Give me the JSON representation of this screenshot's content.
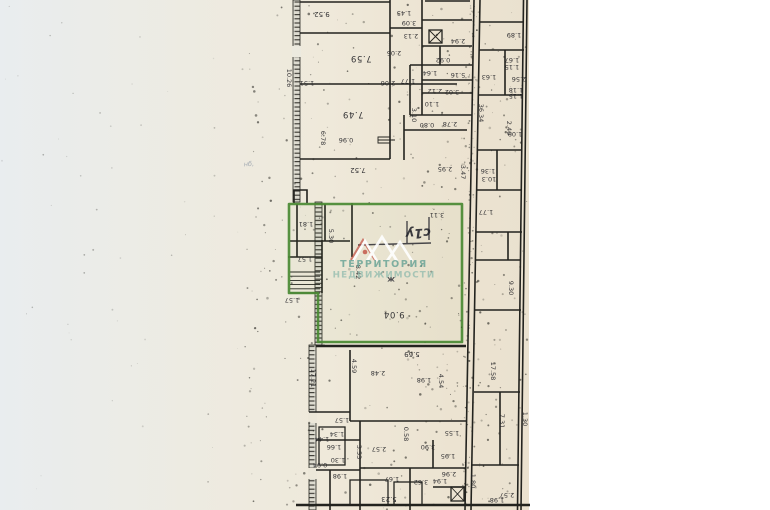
{
  "scan": {
    "paper_tint_left": "#e9edef",
    "paper_tint_mid": "#efe9da",
    "paper_tint_right": "#eae1cf",
    "ink_color": "#26262a",
    "note": "scanned BTI floor plan, rotated 180deg (dimension labels upside down)"
  },
  "highlight": {
    "color": "#4a8a33"
  },
  "watermark": {
    "line1": "ТЕРРИТОРИЯ",
    "line2": "НЕДВИЖИМОСТИ",
    "color_line1": "#5f9e91",
    "color_line2": "#83b4a8",
    "roof_color": "#ffffff",
    "roof_accent": "#c0493d"
  },
  "plan": {
    "texts": [
      {
        "t": "9.52",
        "x": 322,
        "y": 12,
        "r": 180,
        "c": "dim med"
      },
      {
        "t": "1.45",
        "x": 404,
        "y": 11,
        "r": 180,
        "c": "dim"
      },
      {
        "t": "3.09",
        "x": 409,
        "y": 21,
        "r": 180,
        "c": "dim"
      },
      {
        "t": "2.13",
        "x": 411,
        "y": 34,
        "r": 180,
        "c": "dim"
      },
      {
        "t": "2.94",
        "x": 458,
        "y": 39,
        "r": 180,
        "c": "dim"
      },
      {
        "t": "7.59",
        "x": 361,
        "y": 56,
        "r": 180,
        "c": "dim big"
      },
      {
        "t": "2.05",
        "x": 394,
        "y": 51,
        "r": 180,
        "c": "dim"
      },
      {
        "t": "0.92",
        "x": 443,
        "y": 58,
        "r": 180,
        "c": "dim"
      },
      {
        "t": "1.64",
        "x": 430,
        "y": 71,
        "r": 180,
        "c": "dim"
      },
      {
        "t": "5.16",
        "x": 458,
        "y": 73,
        "r": 180,
        "c": "dim"
      },
      {
        "t": "1.77",
        "x": 408,
        "y": 79,
        "r": 180,
        "c": "dim"
      },
      {
        "t": "2.12",
        "x": 435,
        "y": 89,
        "r": 180,
        "c": "dim"
      },
      {
        "t": "3.02",
        "x": 452,
        "y": 90,
        "r": 180,
        "c": "dim"
      },
      {
        "t": "1.10",
        "x": 432,
        "y": 102,
        "r": 180,
        "c": "dim"
      },
      {
        "t": "3.10",
        "x": 412,
        "y": 115,
        "r": 90,
        "c": "dim"
      },
      {
        "t": "0.80",
        "x": 427,
        "y": 123,
        "r": 180,
        "c": "dim"
      },
      {
        "t": "2.78",
        "x": 450,
        "y": 122,
        "r": 180,
        "c": "dim"
      },
      {
        "t": "10.26",
        "x": 287,
        "y": 78,
        "r": 90,
        "c": "dim"
      },
      {
        "t": "1.51",
        "x": 307,
        "y": 81,
        "r": 180,
        "c": "dim"
      },
      {
        "t": "2.06",
        "x": 388,
        "y": 81,
        "r": 180,
        "c": "dim"
      },
      {
        "t": "7.49",
        "x": 353,
        "y": 112,
        "r": 180,
        "c": "dim big"
      },
      {
        "t": "6.78",
        "x": 321,
        "y": 138,
        "r": 90,
        "c": "dim"
      },
      {
        "t": "0.96",
        "x": 346,
        "y": 138,
        "r": 180,
        "c": "dim"
      },
      {
        "t": "7.52",
        "x": 358,
        "y": 168,
        "r": 180,
        "c": "dim med"
      },
      {
        "t": "2.95",
        "x": 445,
        "y": 167,
        "r": 180,
        "c": "dim"
      },
      {
        "t": "3.47",
        "x": 461,
        "y": 172,
        "r": 90,
        "c": "dim"
      },
      {
        "t": "3.11",
        "x": 437,
        "y": 213,
        "r": 180,
        "c": "dim"
      },
      {
        "t": "1.81",
        "x": 306,
        "y": 222,
        "r": 180,
        "c": "dim"
      },
      {
        "t": "5.30",
        "x": 329,
        "y": 236,
        "r": 90,
        "c": "dim"
      },
      {
        "t": "1.57",
        "x": 305,
        "y": 257,
        "r": 180,
        "c": "dim"
      },
      {
        "t": "8.42",
        "x": 356,
        "y": 272,
        "r": 90,
        "c": "dim"
      },
      {
        "t": "1.57",
        "x": 292,
        "y": 298,
        "r": 180,
        "c": "dim"
      },
      {
        "t": "9.04",
        "x": 394,
        "y": 312,
        "r": 180,
        "c": "dim big"
      },
      {
        "t": "17.21",
        "x": 311,
        "y": 378,
        "r": 90,
        "c": "dim"
      },
      {
        "t": "4.59",
        "x": 352,
        "y": 366,
        "r": 90,
        "c": "dim"
      },
      {
        "t": "2.48",
        "x": 378,
        "y": 371,
        "r": 180,
        "c": "dim"
      },
      {
        "t": "5.69",
        "x": 412,
        "y": 352,
        "r": 180,
        "c": "dim med"
      },
      {
        "t": "1.98",
        "x": 424,
        "y": 378,
        "r": 180,
        "c": "dim"
      },
      {
        "t": "4.54",
        "x": 439,
        "y": 381,
        "r": 90,
        "c": "dim"
      },
      {
        "t": "1.57",
        "x": 342,
        "y": 418,
        "r": 180,
        "c": "dim"
      },
      {
        "t": "1.34",
        "x": 337,
        "y": 432,
        "r": 180,
        "c": "dim"
      },
      {
        "t": "1.44",
        "x": 322,
        "y": 437,
        "r": 180,
        "c": "dim"
      },
      {
        "t": "1.66",
        "x": 334,
        "y": 445,
        "r": 180,
        "c": "dim"
      },
      {
        "t": "3.53",
        "x": 357,
        "y": 452,
        "r": 90,
        "c": "dim"
      },
      {
        "t": "2.57",
        "x": 379,
        "y": 447,
        "r": 180,
        "c": "dim"
      },
      {
        "t": "0.58",
        "x": 404,
        "y": 434,
        "r": 90,
        "c": "dim"
      },
      {
        "t": "3.90",
        "x": 428,
        "y": 445,
        "r": 180,
        "c": "dim"
      },
      {
        "t": "1.95",
        "x": 448,
        "y": 454,
        "r": 180,
        "c": "dim"
      },
      {
        "t": "1.30",
        "x": 338,
        "y": 458,
        "r": 180,
        "c": "dim"
      },
      {
        "t": "0.94",
        "x": 320,
        "y": 463,
        "r": 180,
        "c": "dim"
      },
      {
        "t": "1.98",
        "x": 340,
        "y": 474,
        "r": 180,
        "c": "dim"
      },
      {
        "t": "1.67",
        "x": 392,
        "y": 477,
        "r": 180,
        "c": "dim"
      },
      {
        "t": "3.62",
        "x": 421,
        "y": 480,
        "r": 180,
        "c": "dim"
      },
      {
        "t": "1.94",
        "x": 440,
        "y": 479,
        "r": 180,
        "c": "dim"
      },
      {
        "t": "2.96",
        "x": 449,
        "y": 472,
        "r": 180,
        "c": "dim"
      },
      {
        "t": "5.23",
        "x": 389,
        "y": 497,
        "r": 180,
        "c": "dim med"
      },
      {
        "t": "1.80",
        "x": 471,
        "y": 481,
        "r": 90,
        "c": "dim"
      },
      {
        "t": "2.57",
        "x": 507,
        "y": 493,
        "r": 180,
        "c": "dim"
      },
      {
        "t": "1.98",
        "x": 497,
        "y": 498,
        "r": 180,
        "c": "dim"
      },
      {
        "t": "1.89",
        "x": 514,
        "y": 33,
        "r": 180,
        "c": "dim"
      },
      {
        "t": "1.67",
        "x": 512,
        "y": 58,
        "r": 180,
        "c": "dim"
      },
      {
        "t": "1.15",
        "x": 512,
        "y": 65,
        "r": 180,
        "c": "dim"
      },
      {
        "t": "2.56",
        "x": 519,
        "y": 77,
        "r": 180,
        "c": "dim"
      },
      {
        "t": "1.18",
        "x": 516,
        "y": 88,
        "r": 180,
        "c": "dim"
      },
      {
        "t": "1.15",
        "x": 516,
        "y": 94,
        "r": 180,
        "c": "dim"
      },
      {
        "t": "1.63",
        "x": 489,
        "y": 75,
        "r": 180,
        "c": "dim"
      },
      {
        "t": "36.34",
        "x": 479,
        "y": 113,
        "r": 90,
        "c": "dim"
      },
      {
        "t": "2.40",
        "x": 507,
        "y": 128,
        "r": 90,
        "c": "dim"
      },
      {
        "t": "1.09",
        "x": 515,
        "y": 132,
        "r": 180,
        "c": "dim"
      },
      {
        "t": "1.36",
        "x": 488,
        "y": 169,
        "r": 180,
        "c": "dim"
      },
      {
        "t": "10.3",
        "x": 489,
        "y": 177,
        "r": 180,
        "c": "dim"
      },
      {
        "t": "1.77",
        "x": 486,
        "y": 210,
        "r": 180,
        "c": "dim"
      },
      {
        "t": "9.30",
        "x": 509,
        "y": 288,
        "r": 90,
        "c": "dim"
      },
      {
        "t": "17.58",
        "x": 491,
        "y": 371,
        "r": 90,
        "c": "dim"
      },
      {
        "t": "7.31",
        "x": 500,
        "y": 421,
        "r": 90,
        "c": "dim"
      },
      {
        "t": "1.30",
        "x": 523,
        "y": 419,
        "r": 90,
        "c": "dim"
      },
      {
        "t": "1.55",
        "x": 452,
        "y": 431,
        "r": 180,
        "c": "dim"
      },
      {
        "t": "с1у",
        "x": 418,
        "y": 229,
        "r": 177,
        "c": "hand"
      },
      {
        "t": "ж",
        "x": 391,
        "y": 277,
        "r": 180,
        "c": "scribble"
      },
      {
        "t": "нб,",
        "x": 249,
        "y": 166,
        "r": -4,
        "c": "pencil"
      }
    ]
  }
}
